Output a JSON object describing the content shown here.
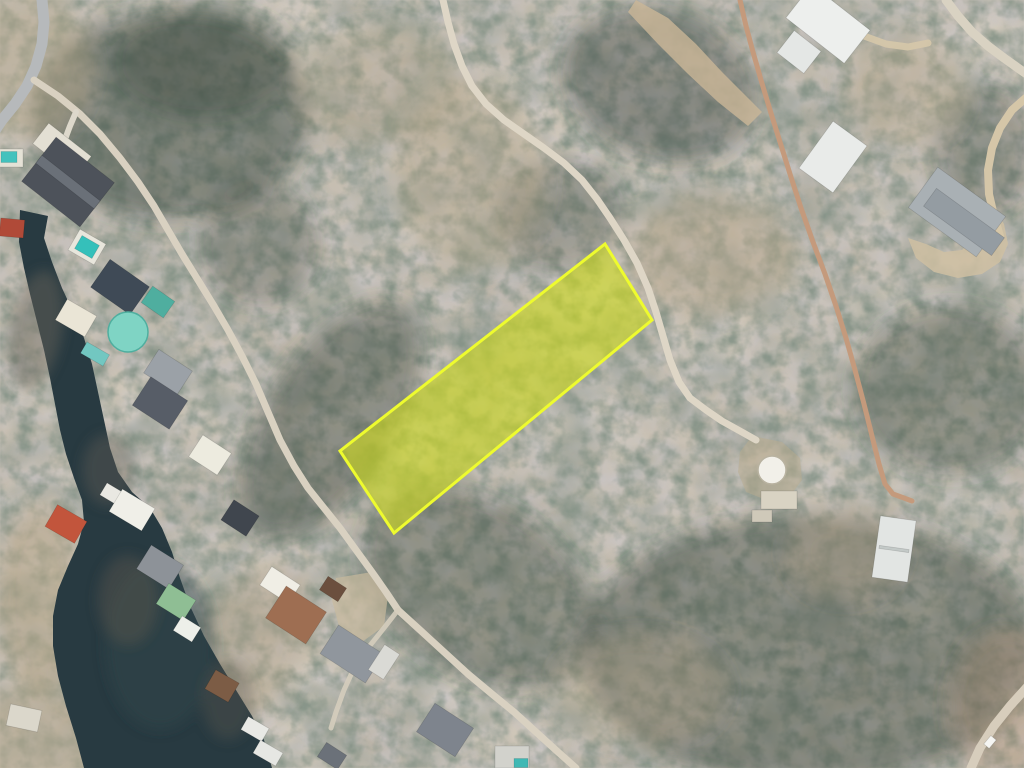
{
  "meta": {
    "view": "aerial-satellite-photo",
    "overlay": "highlighted-lot-boundary"
  },
  "scene": {
    "width": 1024,
    "height": 768,
    "colors": {
      "terrain_base": "#9c9183",
      "water": "#283a41",
      "parcel_fill": "#ccd81c",
      "parcel_stroke": "#eefb2e"
    },
    "parcel": {
      "name": "highlighted-parcel",
      "points": "605,244 652,320 394,533 340,451",
      "fill": "#ccd81c",
      "fill_opacity": 0.62,
      "stroke": "#eefb2e",
      "stroke_width": 3
    },
    "water": {
      "name": "lake-cove",
      "fill": "#283a41",
      "d": "M20,210 L48,216 L44,238 L52,262 L62,288 L74,314 L84,338 L92,364 L98,392 L104,420 L110,448 L118,472 L132,492 L150,508 L162,528 L172,552 L180,578 L190,606 L204,636 L220,664 L236,690 L252,716 L264,740 L272,768 L84,768 L76,738 L66,706 L58,676 L53,646 L53,616 L58,590 L68,566 L78,544 L84,522 L82,500 L74,478 L66,454 L60,430 L55,404 L50,378 L44,350 L37,322 L30,294 L24,268 L19,242 Z"
    },
    "patches": [
      {
        "cx": 170,
        "cy": 115,
        "rx": 140,
        "ry": 105,
        "rot": 0,
        "fill": "#3e4a40",
        "op": 0.5
      },
      {
        "cx": 205,
        "cy": 62,
        "rx": 90,
        "ry": 55,
        "rot": 0,
        "fill": "#3e4a40",
        "op": 0.4
      },
      {
        "cx": 330,
        "cy": 420,
        "rx": 65,
        "ry": 135,
        "rot": 33,
        "fill": "#3e4a40",
        "op": 0.45
      },
      {
        "cx": 260,
        "cy": 245,
        "rx": 60,
        "ry": 60,
        "rot": 0,
        "fill": "#3e4a40",
        "op": 0.3
      },
      {
        "cx": 560,
        "cy": 215,
        "rx": 65,
        "ry": 55,
        "rot": 0,
        "fill": "#3e4a40",
        "op": 0.3
      },
      {
        "cx": 660,
        "cy": 85,
        "rx": 100,
        "ry": 75,
        "rot": 20,
        "fill": "#3e4a40",
        "op": 0.42
      },
      {
        "cx": 950,
        "cy": 390,
        "rx": 95,
        "ry": 85,
        "rot": 0,
        "fill": "#3e4a40",
        "op": 0.38
      },
      {
        "cx": 985,
        "cy": 150,
        "rx": 50,
        "ry": 65,
        "rot": 0,
        "fill": "#3e4a40",
        "op": 0.3
      },
      {
        "cx": 810,
        "cy": 650,
        "rx": 230,
        "ry": 135,
        "rot": 0,
        "fill": "#3e4a40",
        "op": 0.45
      },
      {
        "cx": 480,
        "cy": 590,
        "rx": 130,
        "ry": 85,
        "rot": 33,
        "fill": "#3e4a40",
        "op": 0.4
      },
      {
        "cx": 710,
        "cy": 255,
        "rx": 85,
        "ry": 60,
        "rot": 0,
        "fill": "#b6a587",
        "op": 0.45
      },
      {
        "cx": 470,
        "cy": 175,
        "rx": 75,
        "ry": 95,
        "rot": 0,
        "fill": "#b2a287",
        "op": 0.38
      },
      {
        "cx": 380,
        "cy": 85,
        "rx": 85,
        "ry": 60,
        "rot": 0,
        "fill": "#b2a287",
        "op": 0.32
      },
      {
        "cx": 640,
        "cy": 690,
        "rx": 85,
        "ry": 55,
        "rot": 0,
        "fill": "#b2a287",
        "op": 0.32
      },
      {
        "cx": 40,
        "cy": 600,
        "rx": 45,
        "ry": 95,
        "rot": 0,
        "fill": "#b6a587",
        "op": 0.55
      },
      {
        "cx": 250,
        "cy": 645,
        "rx": 55,
        "ry": 85,
        "rot": 30,
        "fill": "#b2a287",
        "op": 0.42
      },
      {
        "cx": 25,
        "cy": 65,
        "rx": 65,
        "ry": 75,
        "rot": 0,
        "fill": "#b6a88c",
        "op": 0.5
      },
      {
        "cx": 30,
        "cy": 742,
        "rx": 75,
        "ry": 55,
        "rot": 0,
        "fill": "#b6a88c",
        "op": 0.55
      },
      {
        "cx": 1006,
        "cy": 706,
        "rx": 55,
        "ry": 75,
        "rot": 0,
        "fill": "#b08a6a",
        "op": 0.3
      },
      {
        "cx": 845,
        "cy": 552,
        "rx": 55,
        "ry": 45,
        "rot": 0,
        "fill": "#b2a287",
        "op": 0.38
      },
      {
        "cx": 905,
        "cy": 90,
        "rx": 60,
        "ry": 55,
        "rot": 0,
        "fill": "#b2a287",
        "op": 0.38
      }
    ],
    "shore": [
      {
        "cx": 160,
        "cy": 645,
        "rx": 55,
        "ry": 85,
        "rot": 0,
        "fill": "#33464c",
        "op": 0.5
      },
      {
        "cx": 36,
        "cy": 330,
        "rx": 26,
        "ry": 60,
        "rot": 10,
        "fill": "#6a655c",
        "op": 0.45
      },
      {
        "cx": 128,
        "cy": 600,
        "rx": 30,
        "ry": 45,
        "rot": 0,
        "fill": "#5e594f",
        "op": 0.4
      },
      {
        "cx": 228,
        "cy": 700,
        "rx": 26,
        "ry": 40,
        "rot": 0,
        "fill": "#5e594f",
        "op": 0.35
      },
      {
        "cx": 108,
        "cy": 470,
        "rx": 26,
        "ry": 36,
        "rot": 0,
        "fill": "#6a655c",
        "op": 0.35
      }
    ],
    "clearings": [
      {
        "name": "dirt-clearing",
        "points": "636,0 668,18 696,44 722,72 748,98 762,112 748,126 718,102 688,74 658,44 628,12",
        "fill": "#cbb797",
        "op": 0.8
      },
      {
        "name": "barn-apron",
        "points": "908,238 916,258 934,272 958,278 982,274 1000,262 1008,244 1004,224 994,208 976,202 960,208 972,222 974,238 962,250 944,252 926,244",
        "fill": "#cfc0a2",
        "op": 0.85
      },
      {
        "name": "tank-clearing",
        "points": "752,436 782,442 800,458 802,480 790,496 766,500 746,492 738,472 740,452",
        "fill": "#b9ab8e",
        "op": 0.5
      },
      {
        "name": "yard-clearing",
        "points": "336,578 372,572 388,596 384,626 362,642 340,630 332,600",
        "fill": "#c8b99c",
        "op": 0.7
      }
    ],
    "roads": [
      {
        "name": "paved-road",
        "points": "42,0 44,22 42,44 36,66 27,86 15,104 2,120 -6,132",
        "color": "#b6b9bb",
        "width": 11,
        "op": 1
      },
      {
        "name": "lakeside-dirt-road",
        "points": "34,80 58,96 80,114 100,134 120,158 138,182 154,206 168,230 182,254 198,280 214,306 228,330 242,356 256,384 268,412 280,440 294,466 308,488 324,508 340,528 356,550 372,572 386,592 398,610",
        "color": "#d9d1c1",
        "width": 7,
        "op": 1
      },
      {
        "name": "lakeside-dirt-road-south",
        "points": "398,610 420,630 444,652 468,674 492,694 514,712 536,732 558,752 576,768",
        "color": "#d9d1c1",
        "width": 7,
        "op": 1
      },
      {
        "name": "dock-spur-road",
        "points": "398,610 384,628 368,648 354,668 344,690 336,712 331,728",
        "color": "#d5cdbd",
        "width": 5,
        "op": 0.9
      },
      {
        "name": "main-dirt-road",
        "points": "443,0 448,22 454,44 462,66 472,86 486,104 504,120 524,134 544,148 564,163 582,180 597,199 610,218 624,240 637,263 648,288 656,312 663,336 670,360 679,382 690,398 706,410 722,421 740,431 756,440",
        "color": "#ded6c6",
        "width": 7,
        "op": 1
      },
      {
        "name": "ridge-dirt-trail",
        "points": "740,0 746,26 753,52 761,80 770,110 780,142 790,174 801,208 813,242 825,274 836,306 846,338 855,370 864,404 872,436 879,464 885,484 893,494 904,498 912,501",
        "color": "#c49a7c",
        "width": 5,
        "op": 1
      },
      {
        "name": "corner-road-ne",
        "points": "946,0 958,16 972,32 988,46 1004,58 1018,68 1028,75",
        "color": "#d9d2c2",
        "width": 9,
        "op": 1
      },
      {
        "name": "barn-access-road",
        "points": "1028,96 1012,110 1000,128 992,148 988,170 989,194 994,216 1000,236",
        "color": "#d5c6a8",
        "width": 8,
        "op": 1
      },
      {
        "name": "corner-road-se",
        "points": "1028,686 1010,706 994,726 980,748 971,768",
        "color": "#d7cdbc",
        "width": 9,
        "op": 1
      },
      {
        "name": "driveway-ne-house",
        "points": "864,36 886,44 908,47 928,43",
        "color": "#d6c8aa",
        "width": 7,
        "op": 0.9
      },
      {
        "name": "driveway-nw-house",
        "points": "76,112 70,126 64,142",
        "color": "#ddd8cb",
        "width": 6,
        "op": 1
      }
    ],
    "buildings": [
      {
        "kind": "rect",
        "x": 62,
        "y": 150,
        "w": 54,
        "h": 26,
        "rot": 38,
        "fill": "#e3dfd3",
        "name": "driveway-pad"
      },
      {
        "kind": "rect",
        "x": 68,
        "y": 182,
        "w": 74,
        "h": 56,
        "rot": 38,
        "fill": "#4d525a",
        "name": "house-roof"
      },
      {
        "kind": "rect",
        "x": 68,
        "y": 182,
        "w": 74,
        "h": 10,
        "rot": 38,
        "fill": "#6a7078",
        "name": "house-ridge"
      },
      {
        "kind": "rect",
        "x": 87,
        "y": 247,
        "w": 30,
        "h": 24,
        "rot": 30,
        "fill": "#e8e6dc",
        "name": "pool-deck"
      },
      {
        "kind": "rect",
        "x": 87,
        "y": 247,
        "w": 20,
        "h": 15,
        "rot": 30,
        "fill": "#35c0ba",
        "name": "swimming-pool"
      },
      {
        "kind": "rect",
        "x": 120,
        "y": 287,
        "w": 48,
        "h": 34,
        "rot": 35,
        "fill": "#3f4a56",
        "name": "house-roof"
      },
      {
        "kind": "rect",
        "x": 158,
        "y": 302,
        "w": 27,
        "h": 20,
        "rot": 35,
        "fill": "#4fae9f",
        "name": "house-roof-teal"
      },
      {
        "kind": "rect",
        "x": 76,
        "y": 318,
        "w": 34,
        "h": 24,
        "rot": 30,
        "fill": "#eae5d6",
        "name": "house-roof-cream"
      },
      {
        "kind": "circle",
        "x": 128,
        "y": 332,
        "r": 20,
        "fill": "#7fd4c4",
        "stroke": "#4fae9f",
        "name": "octagon-teal-roof"
      },
      {
        "kind": "rect",
        "x": 95,
        "y": 354,
        "w": 26,
        "h": 13,
        "rot": 30,
        "fill": "#72c7c1",
        "name": "boat-dock"
      },
      {
        "kind": "rect",
        "x": 168,
        "y": 372,
        "w": 40,
        "h": 28,
        "rot": 33,
        "fill": "#9ba1a7",
        "name": "house-roof"
      },
      {
        "kind": "rect",
        "x": 160,
        "y": 403,
        "w": 44,
        "h": 34,
        "rot": 33,
        "fill": "#575d67",
        "name": "house-roof"
      },
      {
        "kind": "rect",
        "x": 210,
        "y": 455,
        "w": 34,
        "h": 26,
        "rot": 33,
        "fill": "#edebdf",
        "name": "house-roof-white"
      },
      {
        "kind": "rect",
        "x": 240,
        "y": 518,
        "w": 30,
        "h": 24,
        "rot": 33,
        "fill": "#40464e",
        "name": "house-roof"
      },
      {
        "kind": "rect",
        "x": 112,
        "y": 494,
        "w": 20,
        "h": 14,
        "rot": 31,
        "fill": "#e9e8e2",
        "name": "boathouse"
      },
      {
        "kind": "rect",
        "x": 132,
        "y": 510,
        "w": 38,
        "h": 26,
        "rot": 31,
        "fill": "#f0efe8",
        "name": "boathouse"
      },
      {
        "kind": "rect",
        "x": 160,
        "y": 567,
        "w": 38,
        "h": 28,
        "rot": 32,
        "fill": "#8d9298",
        "name": "boathouse"
      },
      {
        "kind": "rect",
        "x": 176,
        "y": 602,
        "w": 32,
        "h": 24,
        "rot": 32,
        "fill": "#8fbe94",
        "name": "boathouse-green"
      },
      {
        "kind": "rect",
        "x": 187,
        "y": 629,
        "w": 22,
        "h": 17,
        "rot": 32,
        "fill": "#edefe9",
        "name": "boathouse"
      },
      {
        "kind": "rect",
        "x": 66,
        "y": 524,
        "w": 34,
        "h": 25,
        "rot": 30,
        "fill": "#c2553c",
        "name": "boathouse-red"
      },
      {
        "kind": "rect",
        "x": 24,
        "y": 718,
        "w": 32,
        "h": 22,
        "rot": 12,
        "fill": "#dbd7cb",
        "name": "shed"
      },
      {
        "kind": "rect",
        "x": 12,
        "y": 228,
        "w": 24,
        "h": 18,
        "rot": 5,
        "fill": "#b04a38",
        "name": "structure-red"
      },
      {
        "kind": "rect",
        "x": 10,
        "y": 158,
        "w": 26,
        "h": 18,
        "rot": 0,
        "fill": "#e5e2d6",
        "name": "pool-deck"
      },
      {
        "kind": "rect",
        "x": 9,
        "y": 157,
        "w": 16,
        "h": 11,
        "rot": 0,
        "fill": "#43c2bd",
        "name": "swimming-pool"
      },
      {
        "kind": "rect",
        "x": 222,
        "y": 686,
        "w": 27,
        "h": 22,
        "rot": 30,
        "fill": "#7c5c45",
        "name": "boathouse-brown"
      },
      {
        "kind": "rect",
        "x": 255,
        "y": 729,
        "w": 24,
        "h": 15,
        "rot": 30,
        "fill": "#e9e9e5",
        "name": "boat-dock"
      },
      {
        "kind": "rect",
        "x": 268,
        "y": 753,
        "w": 26,
        "h": 15,
        "rot": 30,
        "fill": "#e6e7e3",
        "name": "boat-dock"
      },
      {
        "kind": "rect",
        "x": 280,
        "y": 585,
        "w": 34,
        "h": 22,
        "rot": 33,
        "fill": "#f0eee5",
        "name": "house-roof-white"
      },
      {
        "kind": "rect",
        "x": 296,
        "y": 615,
        "w": 48,
        "h": 38,
        "rot": 33,
        "fill": "#9e6e52",
        "name": "house-roof-brown"
      },
      {
        "kind": "rect",
        "x": 333,
        "y": 589,
        "w": 22,
        "h": 16,
        "rot": 33,
        "fill": "#6b4f3e",
        "name": "house-wing"
      },
      {
        "kind": "rect",
        "x": 352,
        "y": 654,
        "w": 54,
        "h": 34,
        "rot": 33,
        "fill": "#90969d",
        "name": "house-roof"
      },
      {
        "kind": "rect",
        "x": 384,
        "y": 662,
        "w": 18,
        "h": 30,
        "rot": 33,
        "fill": "#dadad5",
        "name": "trailer"
      },
      {
        "kind": "rect",
        "x": 445,
        "y": 730,
        "w": 46,
        "h": 34,
        "rot": 33,
        "fill": "#7e848d",
        "name": "house-roof"
      },
      {
        "kind": "rect",
        "x": 332,
        "y": 756,
        "w": 24,
        "h": 17,
        "rot": 33,
        "fill": "#6b7179",
        "name": "structure"
      },
      {
        "kind": "rect",
        "x": 512,
        "y": 757,
        "w": 34,
        "h": 22,
        "rot": 0,
        "fill": "#d2d2cc",
        "name": "structure"
      },
      {
        "kind": "rect",
        "x": 521,
        "y": 763,
        "w": 14,
        "h": 9,
        "rot": 0,
        "fill": "#3fb8b4",
        "name": "swimming-pool"
      },
      {
        "kind": "rect",
        "x": 828,
        "y": 24,
        "w": 74,
        "h": 42,
        "rot": 38,
        "fill": "#edefed",
        "name": "house-roof-white"
      },
      {
        "kind": "rect",
        "x": 799,
        "y": 52,
        "w": 34,
        "h": 28,
        "rot": 38,
        "fill": "#e4e7e5",
        "name": "house-wing"
      },
      {
        "kind": "rect",
        "x": 833,
        "y": 157,
        "w": 42,
        "h": 58,
        "rot": 36,
        "fill": "#e9ebe9",
        "name": "house-roof-white"
      },
      {
        "kind": "rect",
        "x": 957,
        "y": 212,
        "w": 84,
        "h": 50,
        "rot": 36,
        "fill": "#a9b0b4",
        "name": "barn-roof"
      },
      {
        "kind": "rect",
        "x": 964,
        "y": 222,
        "w": 84,
        "h": 22,
        "rot": 36,
        "fill": "#949ca2",
        "name": "barn-roof-half"
      },
      {
        "kind": "circle",
        "x": 772,
        "y": 470,
        "r": 14,
        "fill": "#f2f0e9",
        "stroke": "#b8b2a0",
        "name": "water-tank"
      },
      {
        "kind": "rect",
        "x": 779,
        "y": 500,
        "w": 36,
        "h": 18,
        "rot": 0,
        "fill": "#d9d3c3",
        "name": "concrete-pad"
      },
      {
        "kind": "rect",
        "x": 762,
        "y": 516,
        "w": 20,
        "h": 12,
        "rot": 0,
        "fill": "#cfc9b9",
        "name": "concrete-pad"
      },
      {
        "kind": "rect",
        "x": 894,
        "y": 549,
        "w": 36,
        "h": 62,
        "rot": 8,
        "fill": "#e2e5e3",
        "name": "metal-shed"
      },
      {
        "kind": "rect",
        "x": 894,
        "y": 549,
        "w": 30,
        "h": 3,
        "rot": 8,
        "fill": "#c3c9c7",
        "name": "shed-ridge"
      },
      {
        "kind": "rect",
        "x": 990,
        "y": 742,
        "w": 7,
        "h": 11,
        "rot": 40,
        "fill": "#f5f5f2",
        "name": "vehicle"
      }
    ]
  }
}
